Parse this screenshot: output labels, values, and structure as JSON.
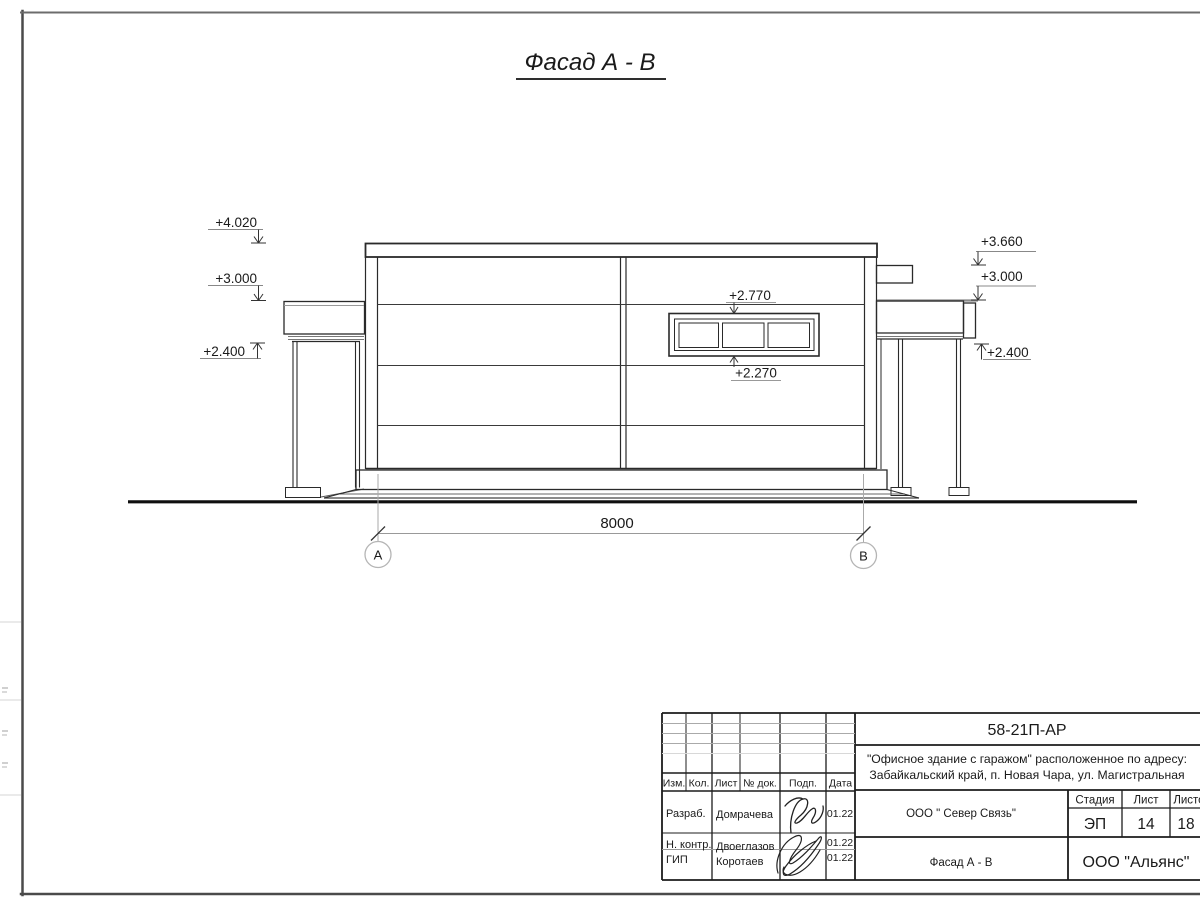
{
  "colors": {
    "line": "#1a1a1a",
    "background": "#ffffff"
  },
  "drawing": {
    "title": "Фасад А - В",
    "marks": {
      "l1": "+4.020",
      "l2": "+3.000",
      "l3": "+2.400",
      "r1": "+3.660",
      "r2": "+3.000",
      "r3": "+2.400",
      "w_top": "+2.770",
      "w_bottom": "+2.270"
    },
    "dimension": {
      "width": "8000",
      "axis_a": "А",
      "axis_b": "В"
    }
  },
  "title_block": {
    "doc_number": "58-21П-АР",
    "project_line1": "\"Офисное здание с гаражом\" расположенное по адресу:",
    "project_line2": "Забайкальский край, п. Новая Чара, ул. Магистральная",
    "columns": {
      "izm": "Изм.",
      "kol": "Кол.",
      "list": "Лист",
      "doc": "№ док.",
      "podp": "Подп.",
      "data": "Дата"
    },
    "rows": [
      {
        "role": "Разраб.",
        "name": "Домрачева",
        "date": "01.22"
      },
      {
        "role": "Н. контр.",
        "name": "Двоеглазов",
        "date": "01.22"
      },
      {
        "role": "ГИП",
        "name": "Коротаев",
        "date": "01.22"
      }
    ],
    "client": "ООО \" Север Связь\"",
    "stage_label": "Стадия",
    "sheet_label": "Лист",
    "sheets_label": "Листов",
    "stage": "ЭП",
    "sheet": "14",
    "sheets": "18",
    "view_name": "Фасад А - В",
    "company": "ООО \"Альянс\""
  }
}
